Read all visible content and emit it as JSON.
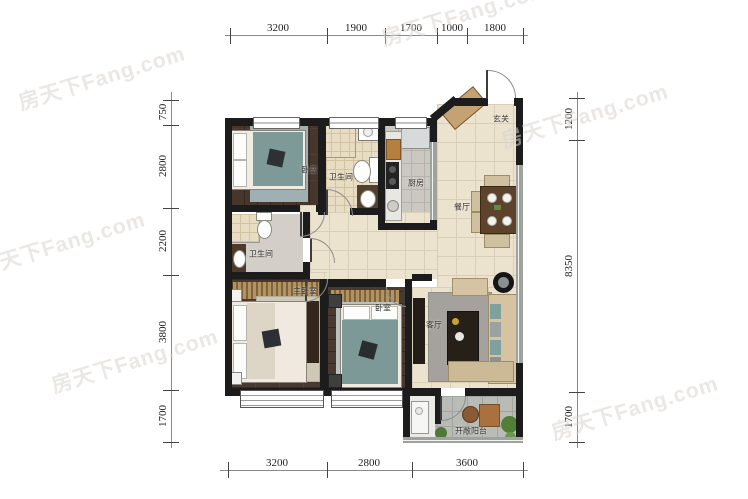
{
  "watermark": {
    "text": "房天下Fang.com"
  },
  "rooms": {
    "bedroom_top": "卧室",
    "bath_top": "卫生间",
    "kitchen": "厨房",
    "entry": "玄关",
    "dining": "餐厅",
    "bath_mid": "卫生间",
    "master": "主卧室",
    "bedroom2": "卧室",
    "living": "客厅",
    "balcony": "开敞阳台"
  },
  "dims": {
    "top": [
      "3200",
      "1900",
      "1700",
      "1000",
      "1800"
    ],
    "bottom": [
      "3200",
      "2800",
      "3600"
    ],
    "left": [
      "750",
      "2800",
      "2200",
      "3800",
      "1700"
    ],
    "right": [
      "1200",
      "8350",
      "1700"
    ]
  },
  "palette": {
    "wall": "#1c1c1c",
    "wood_floor": "#46362c",
    "tile_floor": "#ece3cf",
    "kitchen_floor": "#cbc8c2",
    "balcony_floor": "#b9bcb6",
    "teal_bedding": "#7c9997",
    "sofa_tan": "#d6c3a2",
    "plant_green": "#517f3a",
    "dim_text": "#222222",
    "watermark_gray": "#d8d4cd"
  }
}
